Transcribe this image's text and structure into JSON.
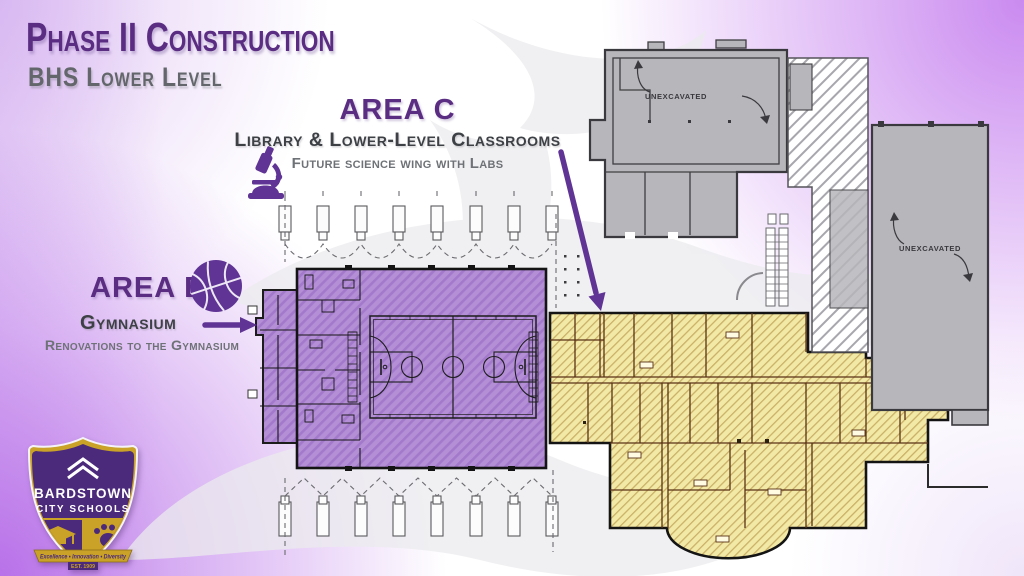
{
  "slide": {
    "title": "Phase II Construction",
    "subtitle": "BHS Lower Level"
  },
  "annotations": {
    "area_c": {
      "heading": "AREA C",
      "subheading": "Library & Lower-Level Classrooms",
      "detail": "Future science wing with Labs",
      "icon": "microscope-icon"
    },
    "area_b": {
      "heading": "AREA B",
      "subheading": "Gymnasium",
      "detail": "Renovations to the Gymnasium",
      "icon": "basketball-icon"
    }
  },
  "floorplan": {
    "unexcavated_upper": "UNEXCAVATED",
    "unexcavated_right": "UNEXCAVATED"
  },
  "logo": {
    "name_line1": "BARDSTOWN",
    "name_line2": "CITY SCHOOLS",
    "motto": "Excellence • Innovation • Diversity",
    "established": "EST. 1909"
  },
  "theme": {
    "title-purple": "#5a2d82",
    "accent-purple": "#5f3494",
    "subtitle-gray": "#63676b",
    "label-dark": "#3d4145",
    "label-gray": "#6e7276",
    "area-b-fill": "#b48fd6",
    "area-b-hatch": "#a379cc",
    "area-c-fill": "#f3e9a6",
    "area-c-hatch": "#d9bf6a",
    "area-c-wall": "#5a3216",
    "gray-fill": "#b7b6ba",
    "gray-wall": "#3f3f42",
    "logo-gold": "#c9a227",
    "logo-purple": "#4b2a7b"
  }
}
